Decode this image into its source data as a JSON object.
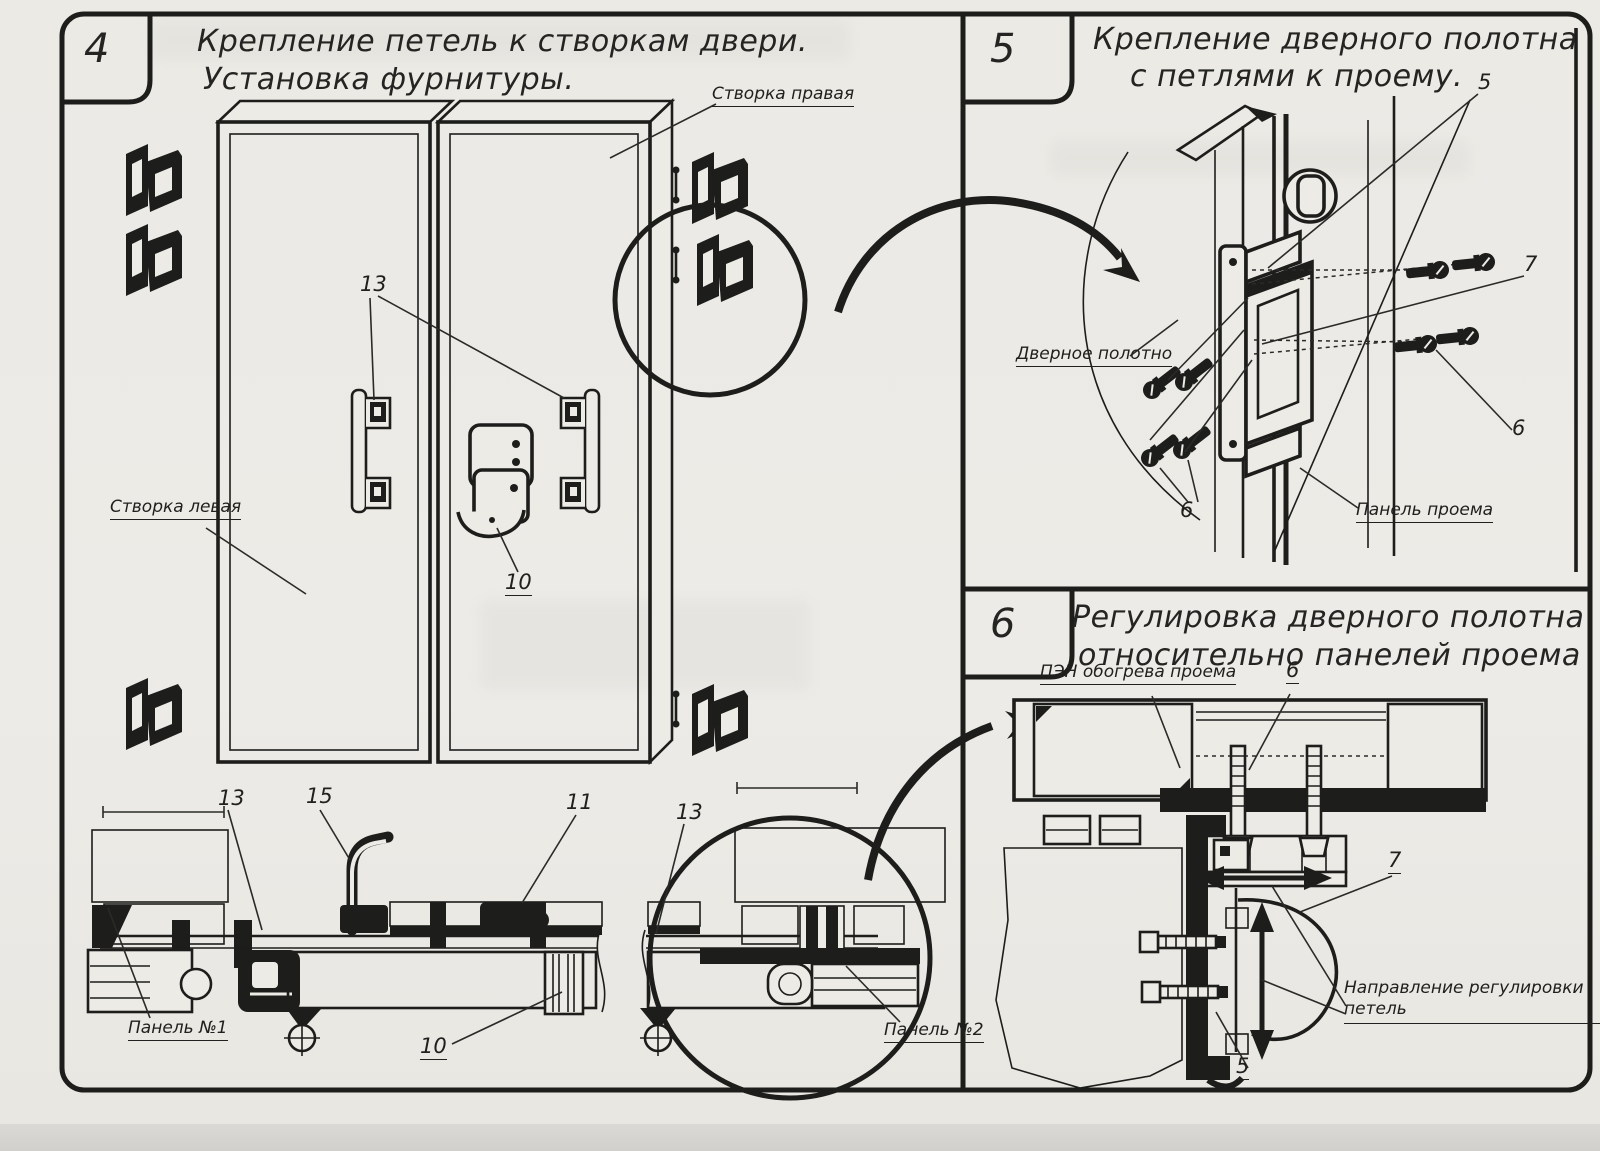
{
  "colors": {
    "ink": "#1d1d1b",
    "paper": "#edebe6",
    "scanner_strip": "#d4d2ce"
  },
  "panel4": {
    "number": "4",
    "title1": "Крепление петель к створкам двери.",
    "title2": "Установка фурнитуры.",
    "label_right_leaf": "Створка правая",
    "label_left_leaf": "Створка левая",
    "label_panel1": "Панель №1",
    "label_panel2": "Панель №2",
    "callout_13_handles": "13",
    "callout_10_lock": "10",
    "callout_13_section_left": "13",
    "callout_15_handle": "15",
    "callout_11_lock_section": "11",
    "callout_13_section_right": "13",
    "callout_10_section": "10"
  },
  "panel5": {
    "number": "5",
    "title1": "Крепление дверного полотна",
    "title2": "с петлями к проему.",
    "label_door_leaf": "Дверное полотно",
    "label_opening_panel": "Панель проема",
    "callout_5": "5",
    "callout_7": "7",
    "callout_6_right": "6",
    "callout_6_left": "6"
  },
  "panel6": {
    "number": "6",
    "title1": "Регулировка дверного полотна",
    "title2": "относительно панелей проема",
    "label_heater": "ПЭН обогрева проема",
    "label_adjust1": "Направление регулировки",
    "label_adjust2": "петель",
    "callout_6": "6",
    "callout_7": "7",
    "callout_5": "5"
  }
}
